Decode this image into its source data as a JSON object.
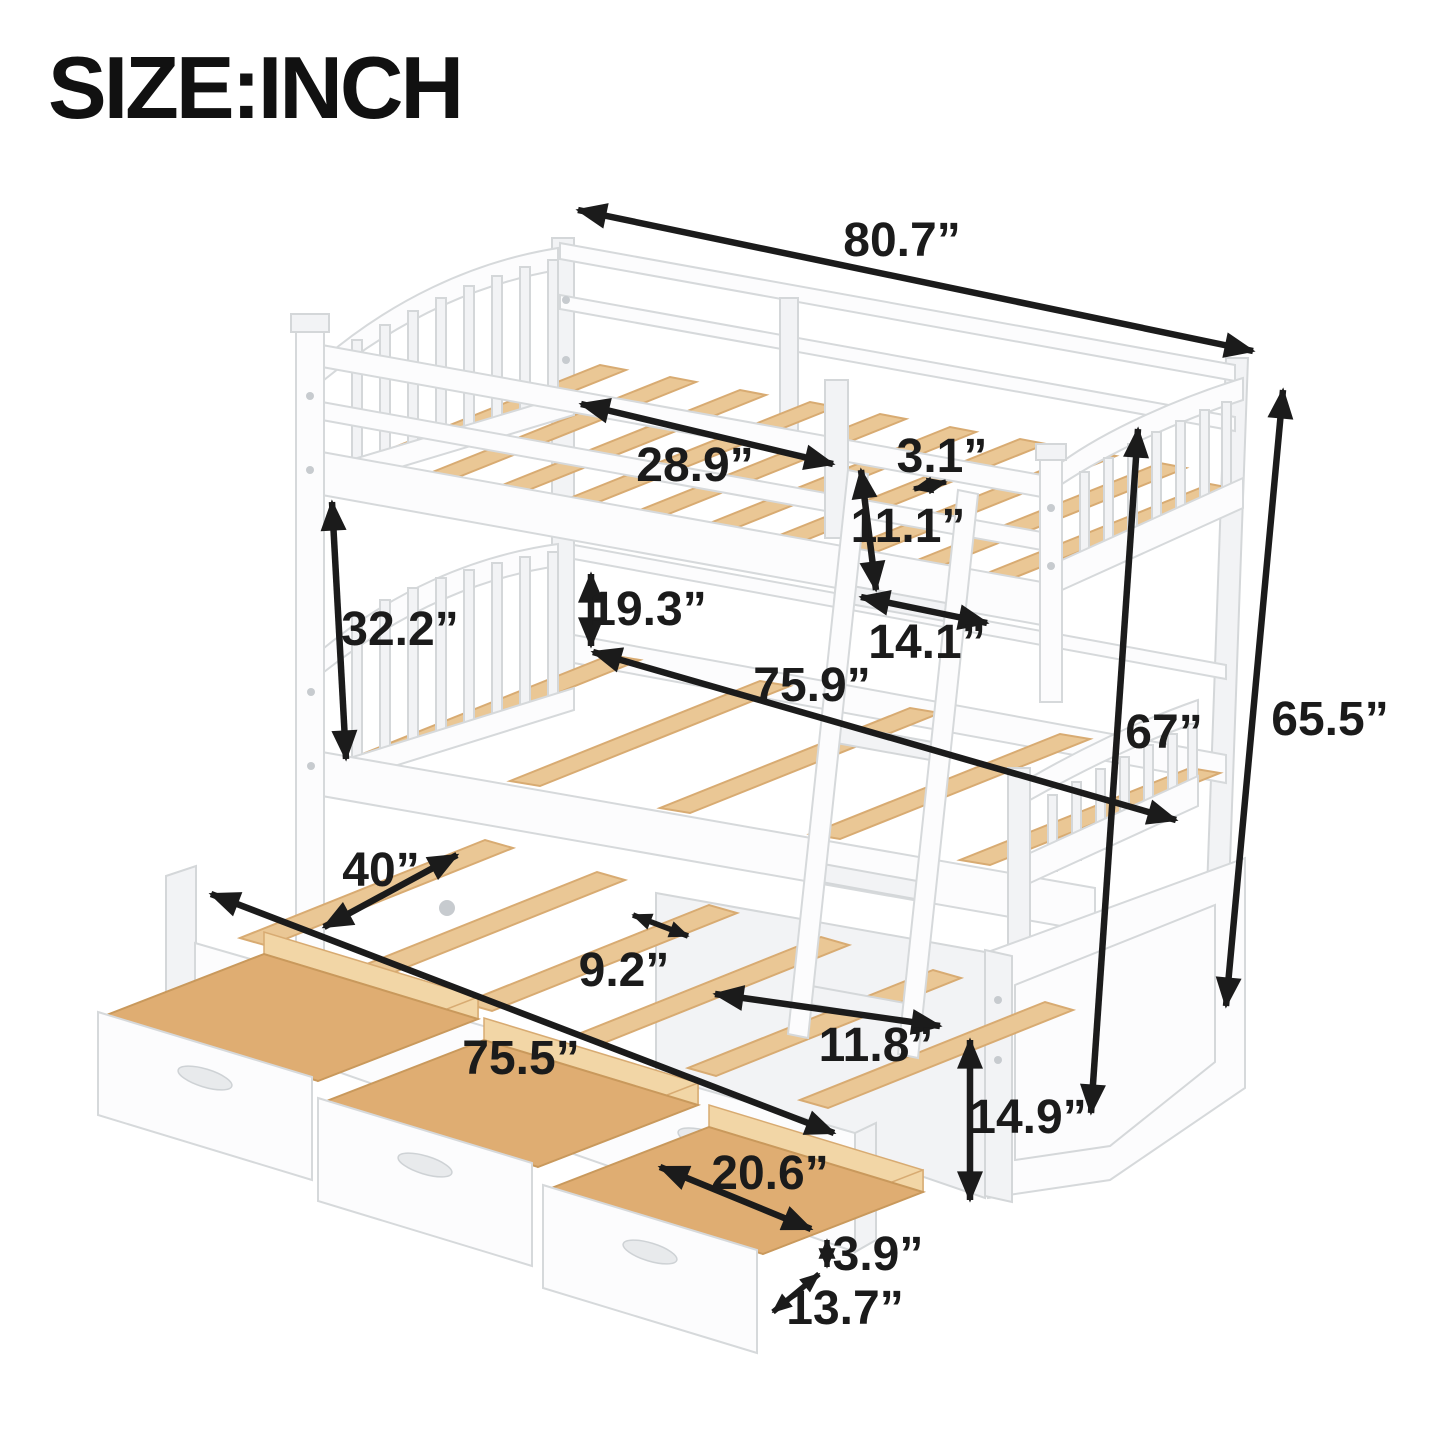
{
  "title": "SIZE:INCH",
  "dims": {
    "overall_length": "80.7”",
    "upper_slat_span": "28.9”",
    "slat_width": "3.1”",
    "guardrail_height": "11.1”",
    "bunk_gap": "19.3”",
    "upper_section_height": "32.2”",
    "bed_end_width": "14.1”",
    "lower_bed_length": "75.9”",
    "rail_floor_height": "67”",
    "overall_height": "65.5”",
    "trundle_pullout": "40”",
    "slat_gap": "9.2”",
    "trundle_length": "75.5”",
    "ladder_width": "11.8”",
    "base_height": "14.9”",
    "drawer_length": "20.6”",
    "drawer_height": "3.9”",
    "drawer_depth": "13.7”"
  },
  "colors": {
    "annotation": "#1b1b1b",
    "frame_white": "#fcfcfd",
    "wood_slat": "#eac795",
    "drawer_interior": "#dfad72",
    "background": "#ffffff"
  }
}
